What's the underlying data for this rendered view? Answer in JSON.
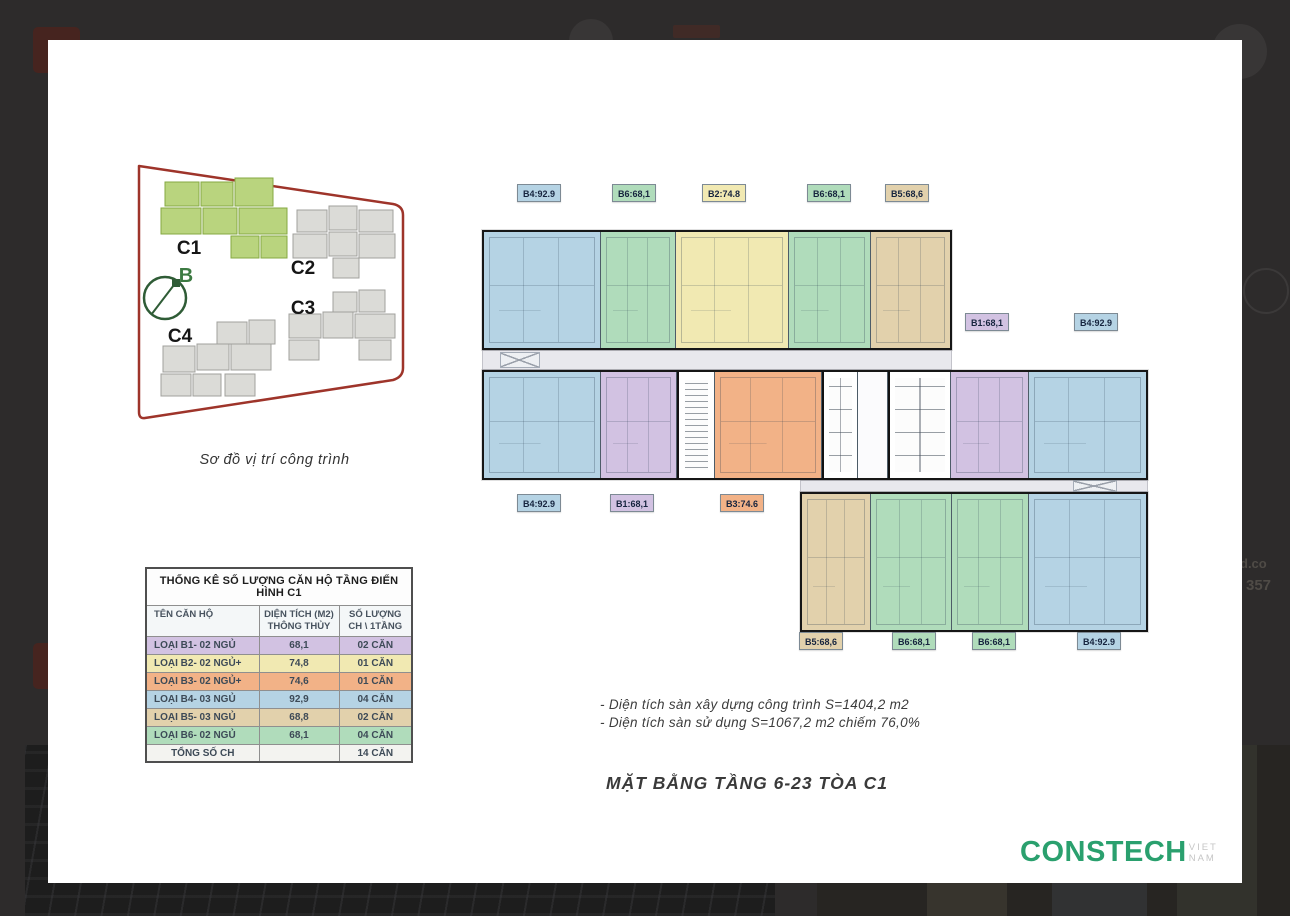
{
  "palette": {
    "b1": "#d2c2e2",
    "b2": "#f1e9b2",
    "b3": "#f2b287",
    "b4": "#b5d3e4",
    "b5": "#e2d1ac",
    "b6": "#b0dcbb"
  },
  "site_diagram": {
    "buildings": [
      {
        "id": "c1",
        "label": "C1",
        "highlighted": true
      },
      {
        "id": "c2",
        "label": "C2",
        "highlighted": false
      },
      {
        "id": "c3",
        "label": "C3",
        "highlighted": false
      },
      {
        "id": "c4",
        "label": "C4",
        "highlighted": false
      }
    ],
    "compass_label": "B",
    "caption": "Sơ đồ vị trí công trình"
  },
  "table": {
    "title": "THỐNG KÊ SỐ LƯỢNG CĂN HỘ TẦNG ĐIỂN HÌNH C1",
    "headers": {
      "col1": "TÊN CĂN HỘ",
      "col2_line1": "DIỆN TÍCH (M2)",
      "col2_line2": "THÔNG THỦY",
      "col3_line1": "SỐ LƯỢNG",
      "col3_line2": "CH \\ 1TẦNG"
    },
    "rows": [
      {
        "label": "LOẠI B1- 02 NGỦ",
        "area": "68,1",
        "count": "02 CĂN",
        "type": "b1"
      },
      {
        "label": "LOẠI B2- 02 NGỦ+",
        "area": "74,8",
        "count": "01 CĂN",
        "type": "b2"
      },
      {
        "label": "LOẠI B3- 02 NGỦ+",
        "area": "74,6",
        "count": "01 CĂN",
        "type": "b3"
      },
      {
        "label": "LOẠI B4- 03 NGỦ",
        "area": "92,9",
        "count": "04 CĂN",
        "type": "b4"
      },
      {
        "label": "LOẠI B5- 03 NGỦ",
        "area": "68,8",
        "count": "02 CĂN",
        "type": "b5"
      },
      {
        "label": "LOẠI B6- 02 NGỦ",
        "area": "68,1",
        "count": "04 CĂN",
        "type": "b6"
      }
    ],
    "footer": {
      "label": "TỔNG SỐ CH",
      "count": "14 CĂN"
    }
  },
  "plan": {
    "chips": [
      {
        "text": "B4:92.9",
        "type": "b4",
        "left": 469,
        "top": 144
      },
      {
        "text": "B6:68,1",
        "type": "b6",
        "left": 564,
        "top": 144
      },
      {
        "text": "B2:74.8",
        "type": "b2",
        "left": 654,
        "top": 144
      },
      {
        "text": "B6:68,1",
        "type": "b6",
        "left": 759,
        "top": 144
      },
      {
        "text": "B5:68,6",
        "type": "b5",
        "left": 837,
        "top": 144
      },
      {
        "text": "B1:68,1",
        "type": "b1",
        "left": 917,
        "top": 273
      },
      {
        "text": "B4:92.9",
        "type": "b4",
        "left": 1026,
        "top": 273
      },
      {
        "text": "B4:92.9",
        "type": "b4",
        "left": 469,
        "top": 454
      },
      {
        "text": "B1:68,1",
        "type": "b1",
        "left": 562,
        "top": 454
      },
      {
        "text": "B3:74.6",
        "type": "b3",
        "left": 672,
        "top": 454
      },
      {
        "text": "B5:68,6",
        "type": "b5",
        "left": 751,
        "top": 592
      },
      {
        "text": "B6:68,1",
        "type": "b6",
        "left": 844,
        "top": 592
      },
      {
        "text": "B6:68,1",
        "type": "b6",
        "left": 924,
        "top": 592
      },
      {
        "text": "B4:92.9",
        "type": "b4",
        "left": 1029,
        "top": 592
      }
    ]
  },
  "notes": {
    "line1": "- Diện tích sàn xây dựng công trình S=1404,2 m2",
    "line2": "- Diện tích sàn sử dụng S=1067,2 m2 chiếm 76,0%"
  },
  "plan_title": "MẶT BẰNG TẦNG 6-23 TÒA C1",
  "logo": {
    "name": "CONSTECH",
    "suffix": "VIET NAM"
  },
  "overlay": {
    "fragments": [
      "d.co",
      "357"
    ]
  }
}
